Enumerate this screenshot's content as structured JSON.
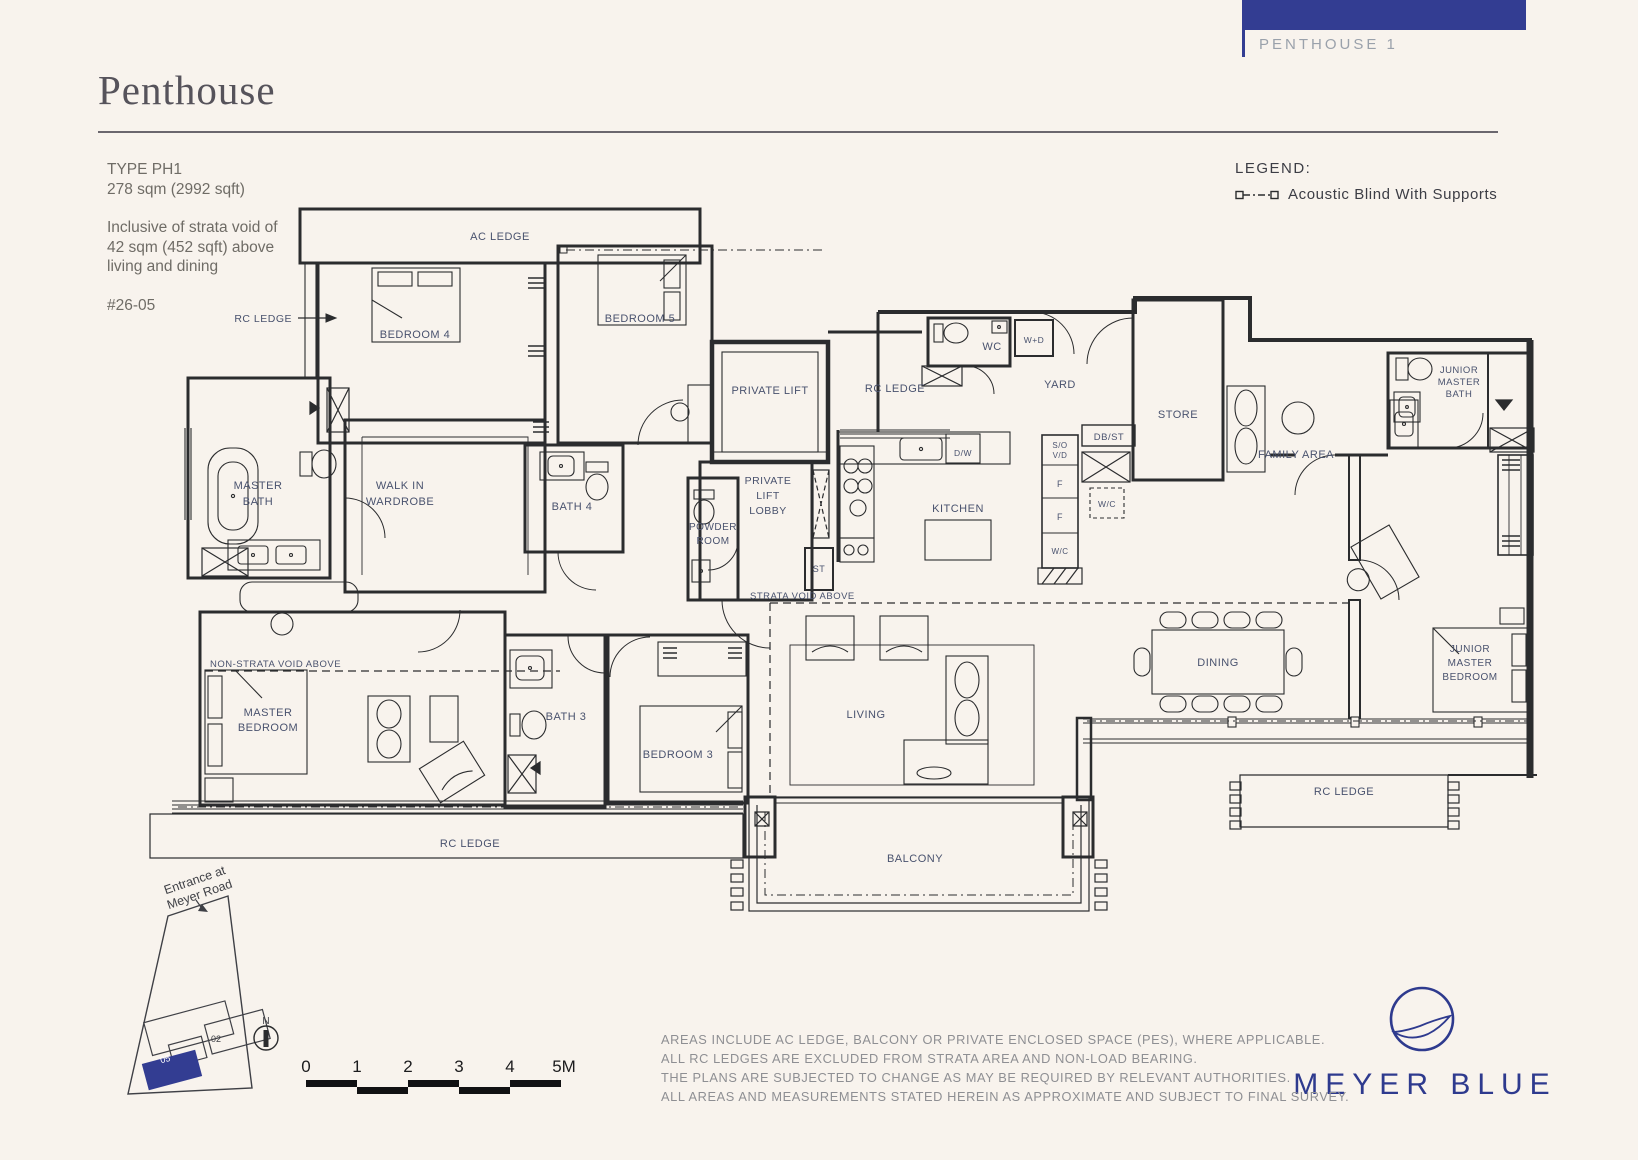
{
  "colors": {
    "navy": "#333d92",
    "plan_line": "#2b2c2e",
    "label": "#49526e",
    "background": "#f8f3ed"
  },
  "header": {
    "tab_label": "PENTHOUSE 1",
    "title": "Penthouse"
  },
  "meta": {
    "type": "TYPE PH1",
    "area": "278 sqm (2992 sqft)",
    "note_line1": "Inclusive of strata void of",
    "note_line2": "42 sqm (452 sqft) above",
    "note_line3": "living and dining",
    "unit": "#26-05"
  },
  "legend": {
    "heading": "LEGEND:",
    "item": "Acoustic Blind With Supports"
  },
  "plan": {
    "labels": [
      {
        "t": "AC LEDGE",
        "x": 500,
        "y": 240
      },
      {
        "t": "RC LEDGE",
        "x": 292,
        "y": 322,
        "anchor": "end",
        "fs": 10.5
      },
      {
        "t": "BEDROOM 4",
        "x": 415,
        "y": 338
      },
      {
        "t": "BEDROOM 5",
        "x": 640,
        "y": 322
      },
      {
        "t": "MASTER",
        "x": 258,
        "y": 489
      },
      {
        "t": "BATH",
        "x": 258,
        "y": 505
      },
      {
        "t": "WALK IN",
        "x": 400,
        "y": 489
      },
      {
        "t": "WARDROBE",
        "x": 400,
        "y": 505
      },
      {
        "t": "BATH 4",
        "x": 572,
        "y": 510
      },
      {
        "t": "POWDER",
        "x": 713,
        "y": 530,
        "fs": 10
      },
      {
        "t": "ROOM",
        "x": 713,
        "y": 544,
        "fs": 10
      },
      {
        "t": "PRIVATE LIFT",
        "x": 770,
        "y": 394
      },
      {
        "t": "PRIVATE",
        "x": 768,
        "y": 484,
        "fs": 10.5
      },
      {
        "t": "LIFT",
        "x": 768,
        "y": 499,
        "fs": 10.5
      },
      {
        "t": "LOBBY",
        "x": 768,
        "y": 514,
        "fs": 10.5
      },
      {
        "t": "ST",
        "x": 819,
        "y": 572,
        "fs": 9
      },
      {
        "t": "RC LEDGE",
        "x": 895,
        "y": 392
      },
      {
        "t": "WC",
        "x": 992,
        "y": 350
      },
      {
        "t": "W+D",
        "x": 1034,
        "y": 343,
        "fs": 8.5
      },
      {
        "t": "YARD",
        "x": 1060,
        "y": 388
      },
      {
        "t": "D/W",
        "x": 963,
        "y": 456,
        "fs": 8.5
      },
      {
        "t": "DB/ST",
        "x": 1109,
        "y": 440,
        "fs": 9.5
      },
      {
        "t": "STORE",
        "x": 1178,
        "y": 418
      },
      {
        "t": "S/O",
        "x": 1060,
        "y": 448,
        "fs": 8
      },
      {
        "t": "V/D",
        "x": 1060,
        "y": 458,
        "fs": 8
      },
      {
        "t": "F",
        "x": 1060,
        "y": 487,
        "fs": 9
      },
      {
        "t": "F",
        "x": 1060,
        "y": 520,
        "fs": 9
      },
      {
        "t": "W/C",
        "x": 1060,
        "y": 554,
        "fs": 8
      },
      {
        "t": "W/C",
        "x": 1107,
        "y": 507,
        "fs": 8.5
      },
      {
        "t": "KITCHEN",
        "x": 958,
        "y": 512
      },
      {
        "t": "FAMILY AREA",
        "x": 1296,
        "y": 458
      },
      {
        "t": "JUNIOR",
        "x": 1459,
        "y": 373,
        "fs": 9.5
      },
      {
        "t": "MASTER",
        "x": 1459,
        "y": 385,
        "fs": 9.5
      },
      {
        "t": "BATH",
        "x": 1459,
        "y": 397,
        "fs": 9.5
      },
      {
        "t": "STRATA VOID ABOVE",
        "x": 750,
        "y": 599,
        "anchor": "start",
        "fs": 9.5
      },
      {
        "t": "NON-STRATA VOID ABOVE",
        "x": 210,
        "y": 667,
        "anchor": "start",
        "fs": 9.5
      },
      {
        "t": "MASTER",
        "x": 268,
        "y": 716
      },
      {
        "t": "BEDROOM",
        "x": 268,
        "y": 731
      },
      {
        "t": "BATH 3",
        "x": 566,
        "y": 720
      },
      {
        "t": "BEDROOM 3",
        "x": 678,
        "y": 758
      },
      {
        "t": "LIVING",
        "x": 866,
        "y": 718
      },
      {
        "t": "DINING",
        "x": 1218,
        "y": 666
      },
      {
        "t": "JUNIOR",
        "x": 1470,
        "y": 652,
        "fs": 10
      },
      {
        "t": "MASTER",
        "x": 1470,
        "y": 666,
        "fs": 10
      },
      {
        "t": "BEDROOM",
        "x": 1470,
        "y": 680,
        "fs": 10
      },
      {
        "t": "BALCONY",
        "x": 915,
        "y": 862
      },
      {
        "t": "RC LEDGE",
        "x": 470,
        "y": 847
      },
      {
        "t": "RC LEDGE",
        "x": 1344,
        "y": 795
      }
    ]
  },
  "site_plan": {
    "entrance_line1": "Entrance at",
    "entrance_line2": "Meyer Road",
    "north": "N",
    "stack_02": "02",
    "stack_05": "05"
  },
  "scale_bar": {
    "ticks": [
      "0",
      "1",
      "2",
      "3",
      "4",
      "5M"
    ]
  },
  "disclaimer": {
    "lines": [
      "AREAS INCLUDE AC LEDGE, BALCONY OR PRIVATE ENCLOSED SPACE (PES), WHERE APPLICABLE.",
      "ALL RC LEDGES ARE EXCLUDED FROM STRATA AREA AND NON-LOAD BEARING.",
      "THE PLANS ARE SUBJECTED TO CHANGE AS MAY BE REQUIRED BY RELEVANT AUTHORITIES.",
      "ALL AREAS AND MEASUREMENTS STATED HEREIN AS APPROXIMATE AND SUBJECT TO FINAL SURVEY."
    ]
  },
  "brand": {
    "name": "MEYER BLUE"
  }
}
